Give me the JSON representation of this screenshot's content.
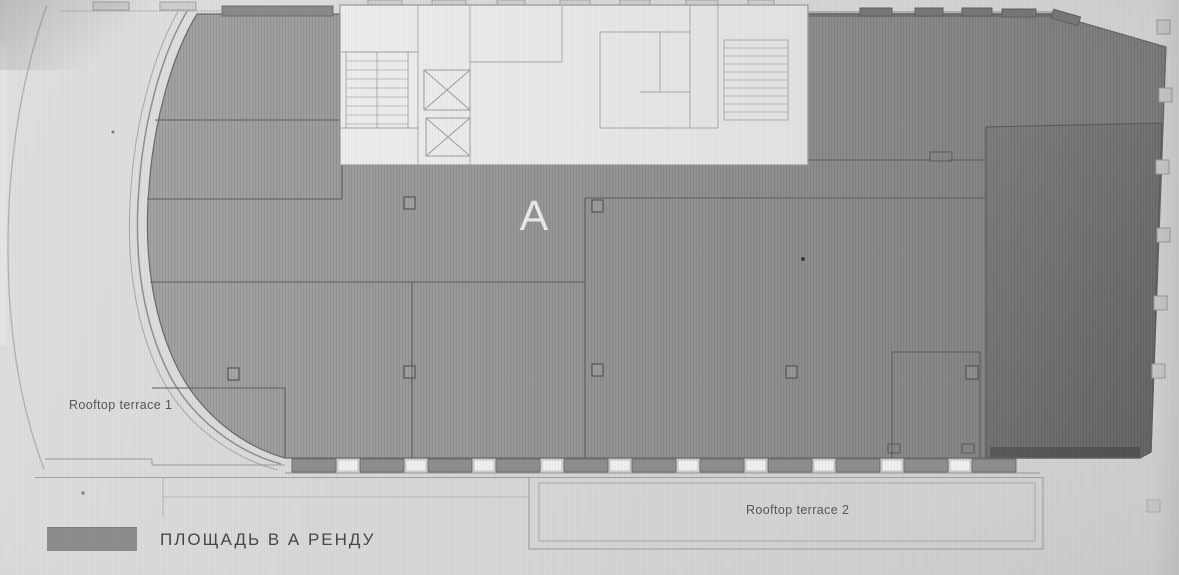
{
  "plan": {
    "unit_label": "A",
    "terrace1_label": "Rooftop terrace 1",
    "terrace2_label": "Rooftop terrace 2"
  },
  "legend": {
    "label": "ПЛОЩАДЬ В А РЕНДУ",
    "swatch_color": "#8d8d8d"
  },
  "colors": {
    "paper": "#d7d7d7",
    "rental_area": "#949494",
    "rental_area_dark": "#707070",
    "core_block": "#eaeaea",
    "line": "#6b6b6b",
    "label_text": "#565656",
    "unit_letter": "#ededed"
  }
}
